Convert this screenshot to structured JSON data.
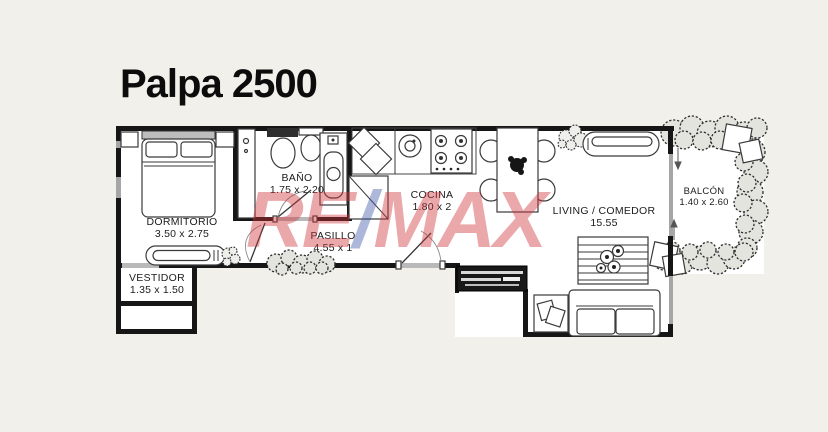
{
  "title": "Palpa 2500",
  "watermark": {
    "part1": "RE",
    "slash": "/",
    "part2": "MAX",
    "letter_color": "#cf3339",
    "slash_color": "#3d55a5"
  },
  "colors": {
    "background": "#f2f0ea",
    "floor": "#ffffff",
    "walls": "#161616"
  },
  "rooms": [
    {
      "id": "dormitorio",
      "name": "DORMITORIO",
      "dims": "3.50 x 2.75"
    },
    {
      "id": "vestidor",
      "name": "VESTIDOR",
      "dims": "1.35 x 1.50"
    },
    {
      "id": "bano",
      "name": "BAÑO",
      "dims": "1.75 x 2.20"
    },
    {
      "id": "pasillo",
      "name": "PASILLO",
      "dims": "4.55 x 1"
    },
    {
      "id": "cocina",
      "name": "COCINA",
      "dims": "1.80 x 2"
    },
    {
      "id": "living",
      "name": "LIVING / COMEDOR",
      "dims": "15.55"
    },
    {
      "id": "balcon",
      "name": "BALCÓN",
      "dims": "1.40 x 2.60"
    }
  ]
}
